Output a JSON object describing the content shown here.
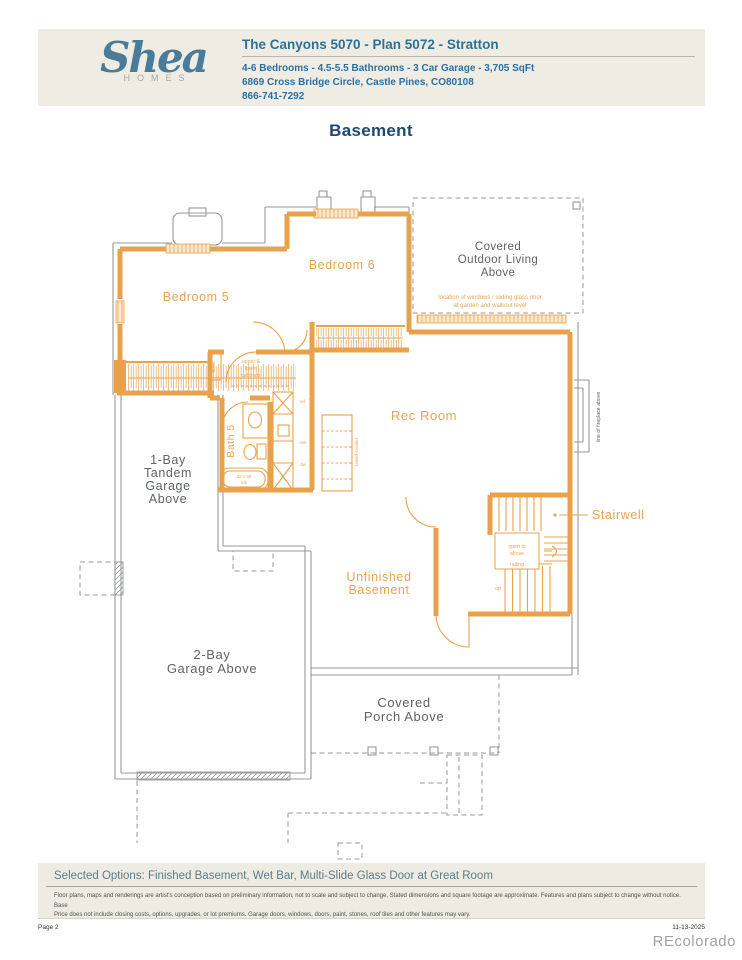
{
  "header": {
    "logo_script": "Shea",
    "logo_sub": "HOMES",
    "title": "The Canyons 5070 - Plan 5072 - Stratton",
    "specs": "4-6 Bedrooms - 4.5-5.5 Bathrooms - 3 Car Garage - 3,705 SqFt",
    "address": "6869 Cross Bridge Circle, Castle Pines, CO80108",
    "phone": "866-741-7292"
  },
  "plan": {
    "title": "Basement",
    "colors": {
      "wall": "#E9A14B",
      "line_gray": "#97999C",
      "label_gray": "#5F6366"
    },
    "labels": {
      "bedroom5": "Bedroom 5",
      "bedroom6": "Bedroom 6",
      "covered_outdoor_1": "Covered",
      "covered_outdoor_2": "Outdoor Living",
      "covered_outdoor_3": "Above",
      "window_note_1": "location of windows / sliding glass door",
      "window_note_2": "at garden and walkout level",
      "rec_room": "Rec Room",
      "bath5": "Bath 5",
      "cabinets_1": "upper &",
      "cabinets_2": "lower",
      "cabinets_3": "cabinets",
      "mech": "mech",
      "tub_1": "32 x 60",
      "tub_2": "tub",
      "ref": "ref.",
      "snk": "snk",
      "dw": "dw",
      "counter_note": "raised counter",
      "stairwell": "Stairwell",
      "open_above_1": "open to",
      "open_above_2": "above",
      "railing": "railing",
      "up": "up",
      "fireplace": "line of fireplace above",
      "garage1_1": "1-Bay",
      "garage1_2": "Tandem",
      "garage1_3": "Garage",
      "garage1_4": "Above",
      "unfinished_1": "Unfinished",
      "unfinished_2": "Basement",
      "garage2_1": "2-Bay",
      "garage2_2": "Garage Above",
      "porch_1": "Covered",
      "porch_2": "Porch Above"
    }
  },
  "footer": {
    "selected_options": "Selected Options: Finished Basement, Wet Bar, Multi-Slide Glass Door at Great Room",
    "disclaimer_1": "Floor plans, maps and renderings are artist's conception based on preliminary information, not to scale and subject to change. Stated dimensions and square footage are approximate. Features and plans subject to change without notice. Base",
    "disclaimer_2": "Price does not include closing costs, options, upgrades, or lot premiums. Garage doors, windows, doors, paint, stones, roof tiles and other features may vary.",
    "page_number": "Page 2",
    "date": "11-13-2025",
    "watermark": "REcolorado"
  }
}
